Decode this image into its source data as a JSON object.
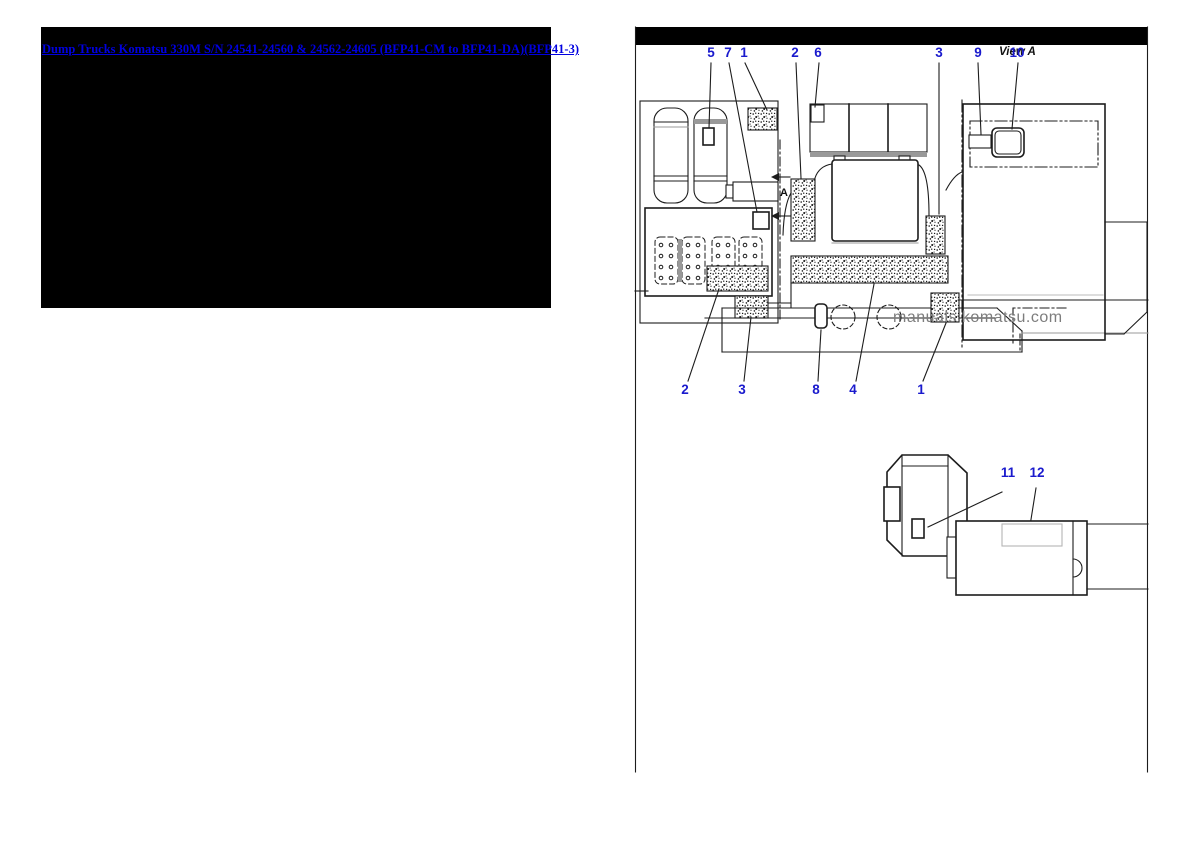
{
  "page": {
    "title_link": "Dump Trucks Komatsu 330M S/N 24541-24560 & 24562-24605 (BFP41-CM to BFP41-DA)(BFP41-3)",
    "watermark": "manuals.komatsu.com",
    "view_label": "View A",
    "section_label": "A"
  },
  "colors": {
    "callout_blue": "#1a1acd",
    "link_blue": "#0000e0",
    "watermark_gray": "#7d7d7d",
    "redaction_black": "#000000"
  },
  "callouts": {
    "top": [
      "5",
      "7",
      "1",
      "2",
      "6",
      "3",
      "9",
      "10"
    ],
    "bottom": [
      "2",
      "3",
      "8",
      "4",
      "1"
    ],
    "detail": [
      "11",
      "12"
    ]
  }
}
